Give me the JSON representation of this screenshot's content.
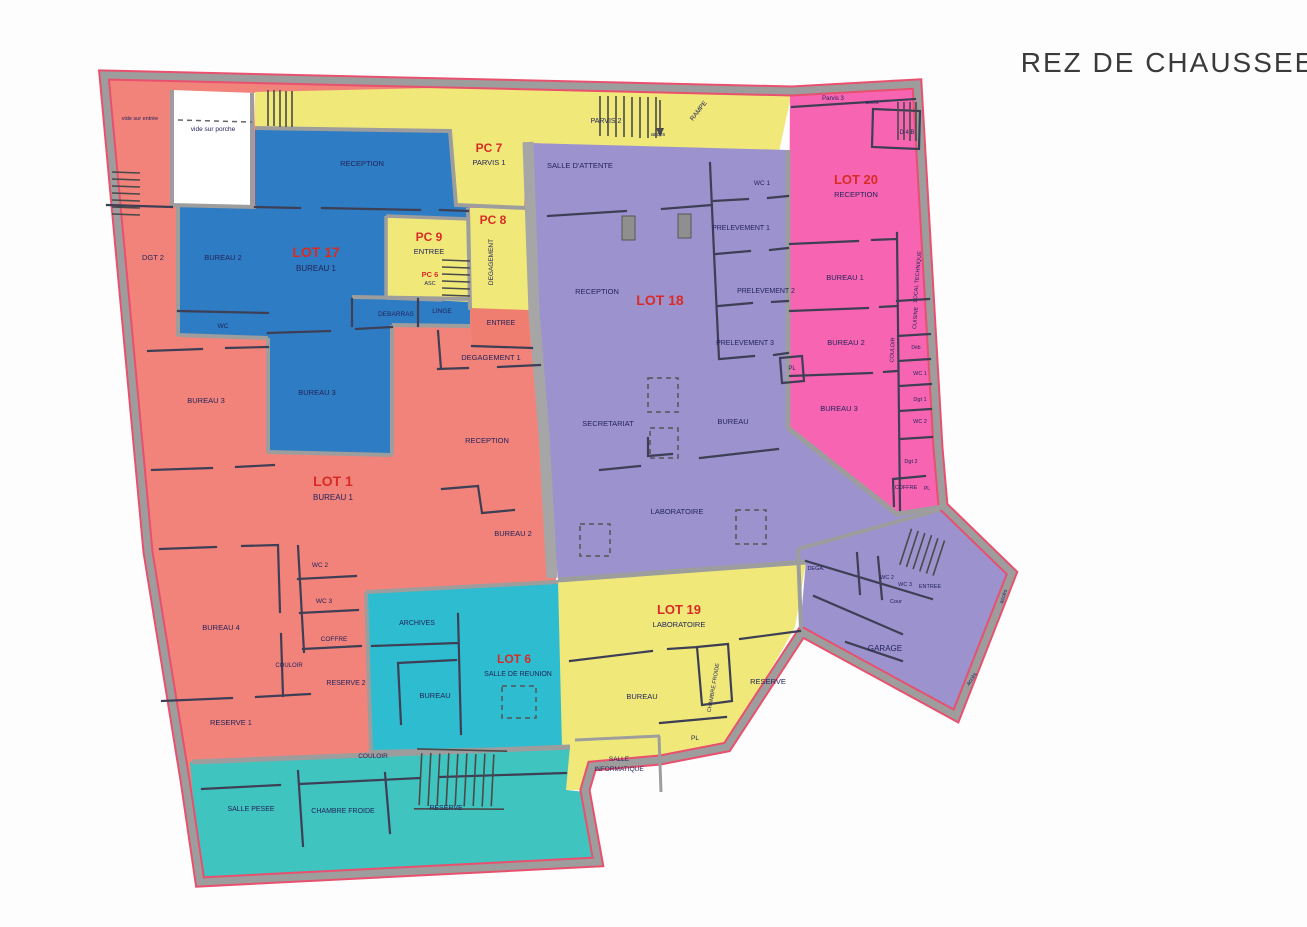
{
  "header": {
    "title": "REZ DE CHAUSSEE"
  },
  "colors": {
    "lot1_salmon": "#F2837B",
    "lot17_blue": "#2E7CC3",
    "yellow": "#F0E97A",
    "lot18_purple": "#9C92CE",
    "lot20_pink": "#F765B2",
    "lot6_cyan": "#35BFC9",
    "wall_gray": "#9D9D9D",
    "outline_red": "#E8506E",
    "lot_title_red": "#D92B25",
    "room_text": "#23235A"
  },
  "zones": {
    "lot1": {
      "title": "LOT 1",
      "subtitle": "BUREAU 1",
      "rooms": {
        "vide_sur_entree": "vide sur entrée",
        "dgt2": "DGT 2",
        "bureau3": "BUREAU 3",
        "bureau4": "BUREAU 4",
        "reception": "RECEPTION",
        "bureau2": "BUREAU 2",
        "degagement1": "DEGAGEMENT 1",
        "entree": "ENTREE",
        "wc2": "WC 2",
        "wc3": "WC 3",
        "coffre": "COFFRE",
        "couloir": "COULOIR",
        "reserve2": "RESERVE 2",
        "reserve1": "RESERVE 1"
      }
    },
    "lot17": {
      "title": "LOT 17",
      "subtitle": "BUREAU 1",
      "rooms": {
        "reception": "RECEPTION",
        "bureau2": "BUREAU 2",
        "wc": "WC",
        "bureau3": "BUREAU 3",
        "debarras": "DEBARRAS",
        "linge": "LINGE"
      }
    },
    "lot18": {
      "title": "LOT 18",
      "rooms": {
        "salle_attente": "SALLE D'ATTENTE",
        "reception": "RECEPTION",
        "wc1": "WC 1",
        "prelevement1": "PRELEVEMENT 1",
        "prelevement2": "PRELEVEMENT 2",
        "prelevement3": "PRELEVEMENT 3",
        "secretariat": "SECRETARIAT",
        "bureau": "BUREAU",
        "laboratoire": "LABORATOIRE",
        "pl": "PL",
        "dega": "DEGA.",
        "wc2": "WC 2",
        "wc3": "WC 3",
        "entree": "ENTREE",
        "cour": "Cour",
        "garage": "GARAGE"
      }
    },
    "lot19": {
      "title": "LOT 19",
      "subtitle": "LABORATOIRE",
      "rooms": {
        "bureau": "BUREAU",
        "chambre_froide": "CHAMBRE FROIDE",
        "reserve": "RESERVE",
        "pl": "PL",
        "salle_info_line1": "SALLE",
        "salle_info_line2": "INFORMATIQUE"
      }
    },
    "lot20": {
      "title": "LOT 20",
      "subtitle": "RECEPTION",
      "rooms": {
        "d4b": "D 4 B",
        "bureau1": "BUREAU 1",
        "bureau2": "BUREAU 2",
        "bureau3": "BUREAU 3",
        "local_technique": "LOCAL TECHNIQUE",
        "cuisine": "CUISINE",
        "couloir": "COULOIR",
        "deb": "Déb",
        "wc1": "WC 1",
        "dgt1": "Dgt 1",
        "wc2": "WC 2",
        "dgt2": "Dgt 2",
        "coffre": "COFFRE",
        "pl": "PL"
      }
    },
    "lot6": {
      "title": "LOT 6",
      "subtitle": "SALLE DE REUNION",
      "rooms": {
        "archives": "ARCHIVES",
        "bureau": "BUREAU",
        "couloir": "COULOIR",
        "salle_pesee": "SALLE PESEE",
        "chambre_froide": "CHAMBRE FROIDE",
        "reserve": "RESERVE"
      }
    },
    "pc7": {
      "title": "PC 7",
      "subtitle": "PARVIS 1"
    },
    "pc8": {
      "title": "PC 8",
      "subtitle": "DEGAGEMENT"
    },
    "pc9": {
      "title": "PC 9",
      "subtitle": "ENTREE"
    },
    "pc6": {
      "title": "PC 6",
      "subtitle": "ASC"
    },
    "common": {
      "vide_sur_porche": "vide sur porche",
      "parvis2": "PARVIS 2",
      "parvis3": "Parvis 3",
      "rampe": "RAMPE",
      "acces": "accès"
    }
  }
}
